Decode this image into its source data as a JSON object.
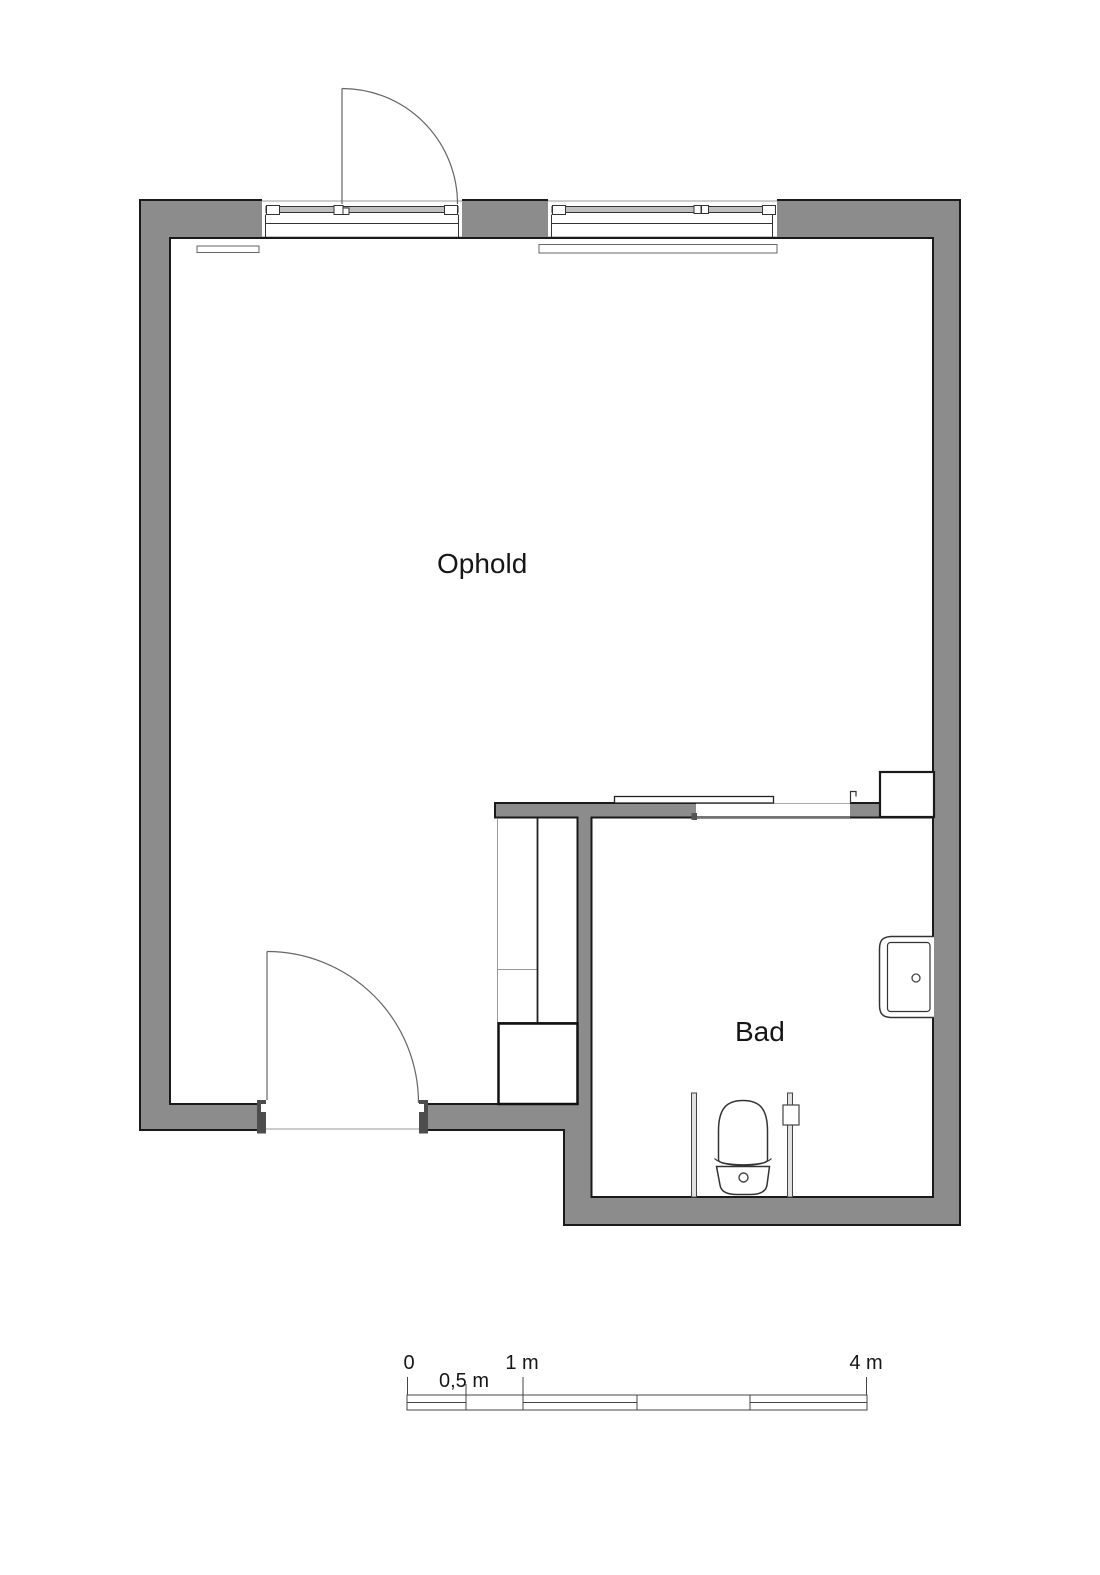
{
  "plan": {
    "rooms": [
      {
        "name": "Ophold"
      },
      {
        "name": "Bad"
      }
    ]
  },
  "scale_bar": {
    "labels": {
      "zero": "0",
      "half": "0,5 m",
      "one": "1 m",
      "four": "4 m"
    }
  },
  "colors": {
    "wall_fill": "#8c8c8c",
    "wall_outline": "#1a1a1a",
    "background": "#ffffff"
  },
  "icons": {
    "toilet": "toilet-plan-symbol",
    "sink": "sink-plan-symbol",
    "closet": "wardrobe-plan-symbol",
    "radiator": "radiator-plan-symbol"
  }
}
